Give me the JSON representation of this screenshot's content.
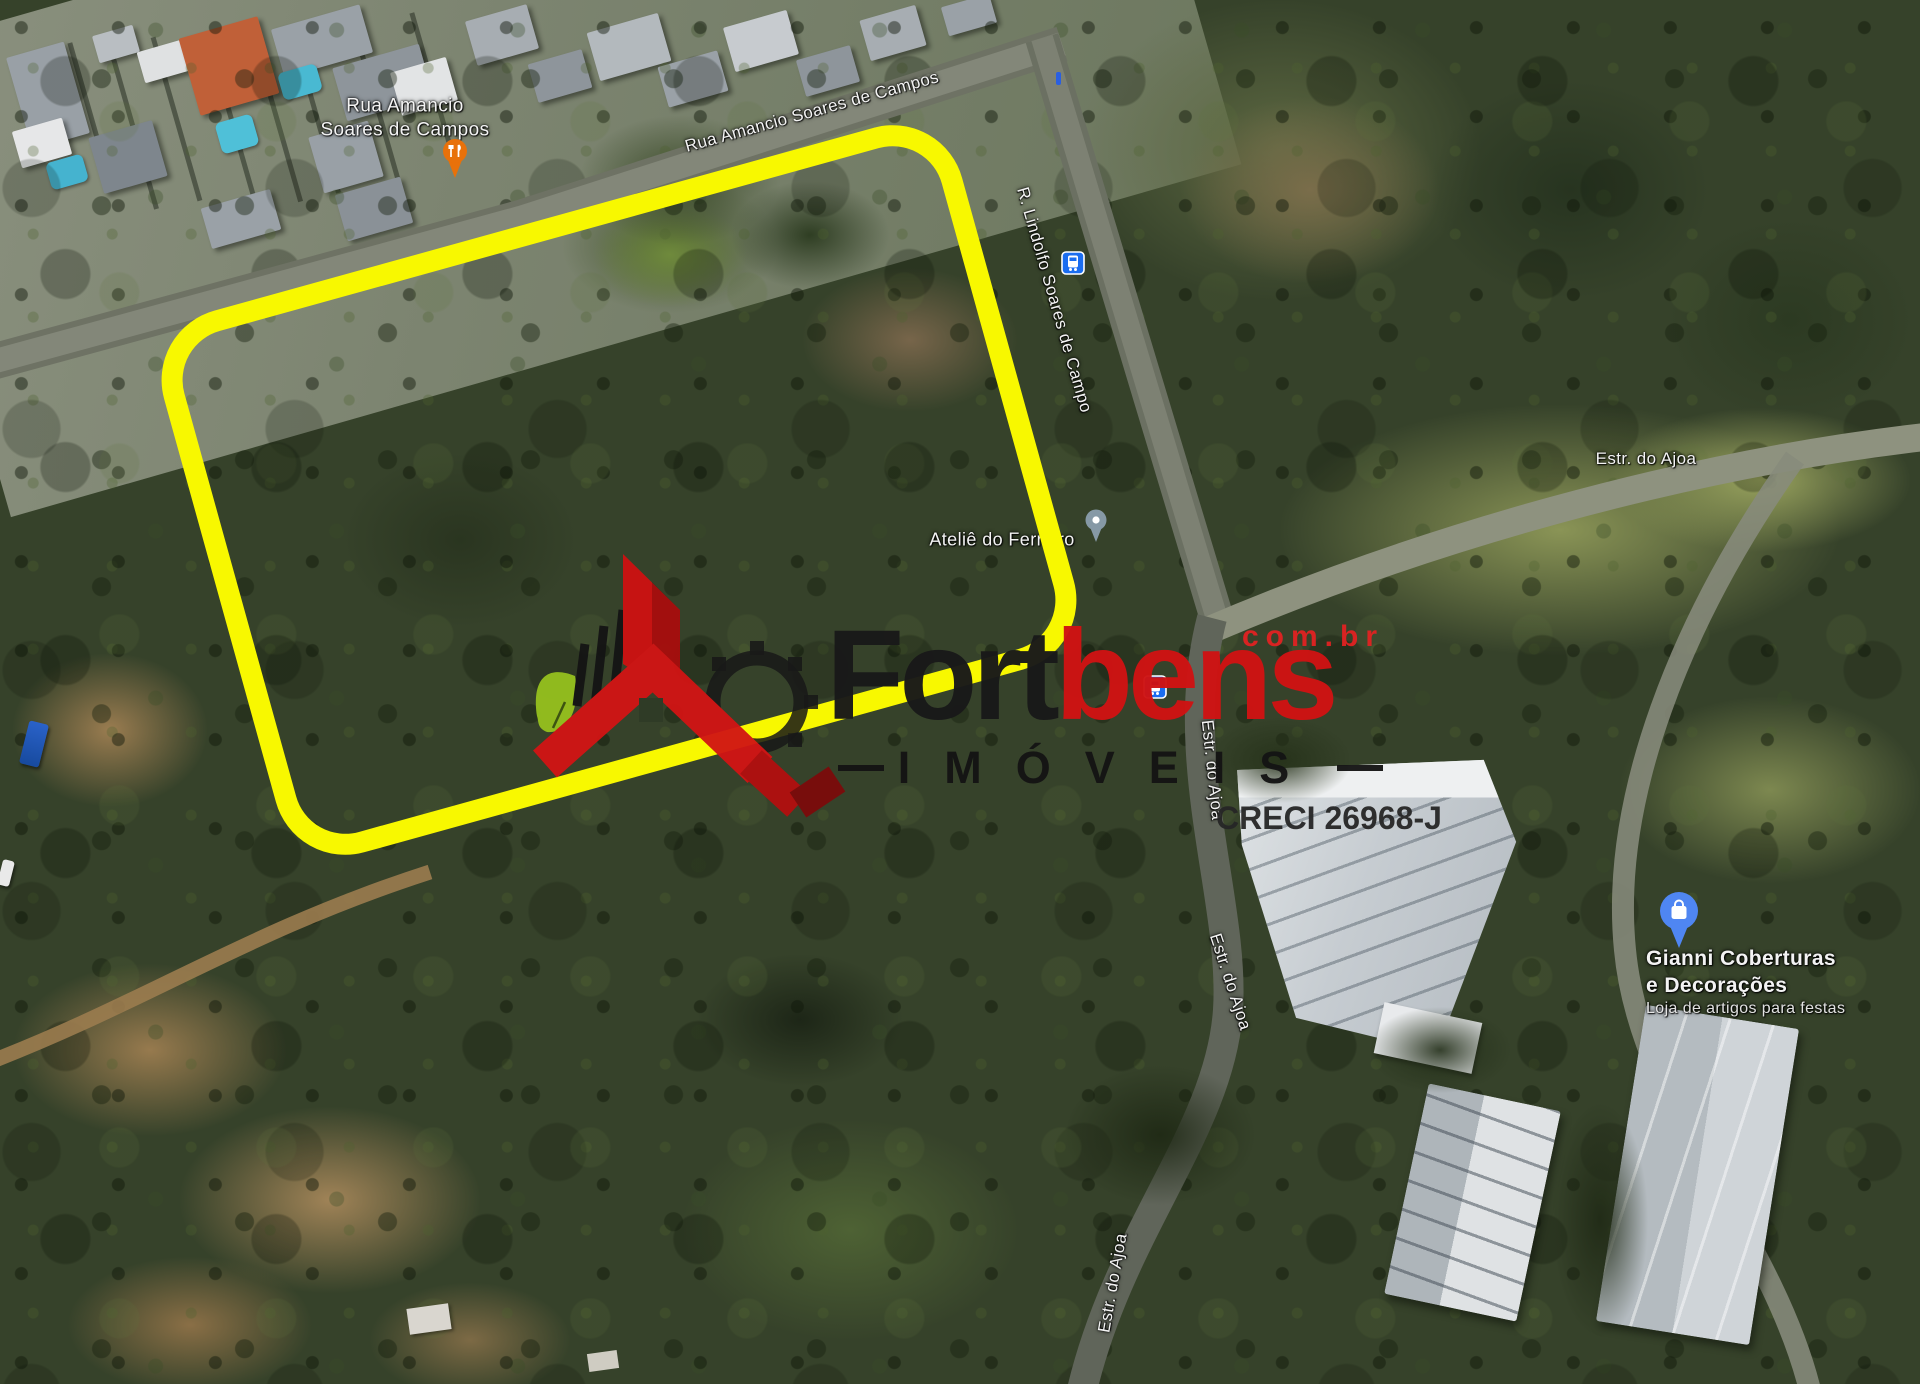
{
  "overlay": {
    "property_outline_color": "#f8f800"
  },
  "watermark": {
    "brand_black": "Fort",
    "brand_red": "bens",
    "domain_suffix": "com.br",
    "tagline": "IMÓVEIS",
    "creci": "CRECI 26968-J",
    "colors": {
      "red": "#cf1313",
      "dark": "#191919",
      "leaf": "#95c11e",
      "outline_yellow": "#f8f800"
    }
  },
  "map_labels": {
    "rua_amancio_line1": "Rua Amancio",
    "rua_amancio_line2": "Soares de Campos",
    "rua_amancio_road": "Rua Amancio Soares de Campos",
    "lindolfo_road": "R. Lindolfo Soares de Campo",
    "atelie": "Ateliê do Ferreiro",
    "estrada_ajoa": "Estr. do Ajoa",
    "gianni_line1": "Gianni Coberturas",
    "gianni_line2": "e Decorações",
    "gianni_subtitle": "Loja de artigos para festas"
  },
  "pins": {
    "restaurant_color": "#e8710a",
    "atelie_color": "#8699a6",
    "gianni_color": "#4f86f2",
    "transit_color": "#1a6df0"
  }
}
